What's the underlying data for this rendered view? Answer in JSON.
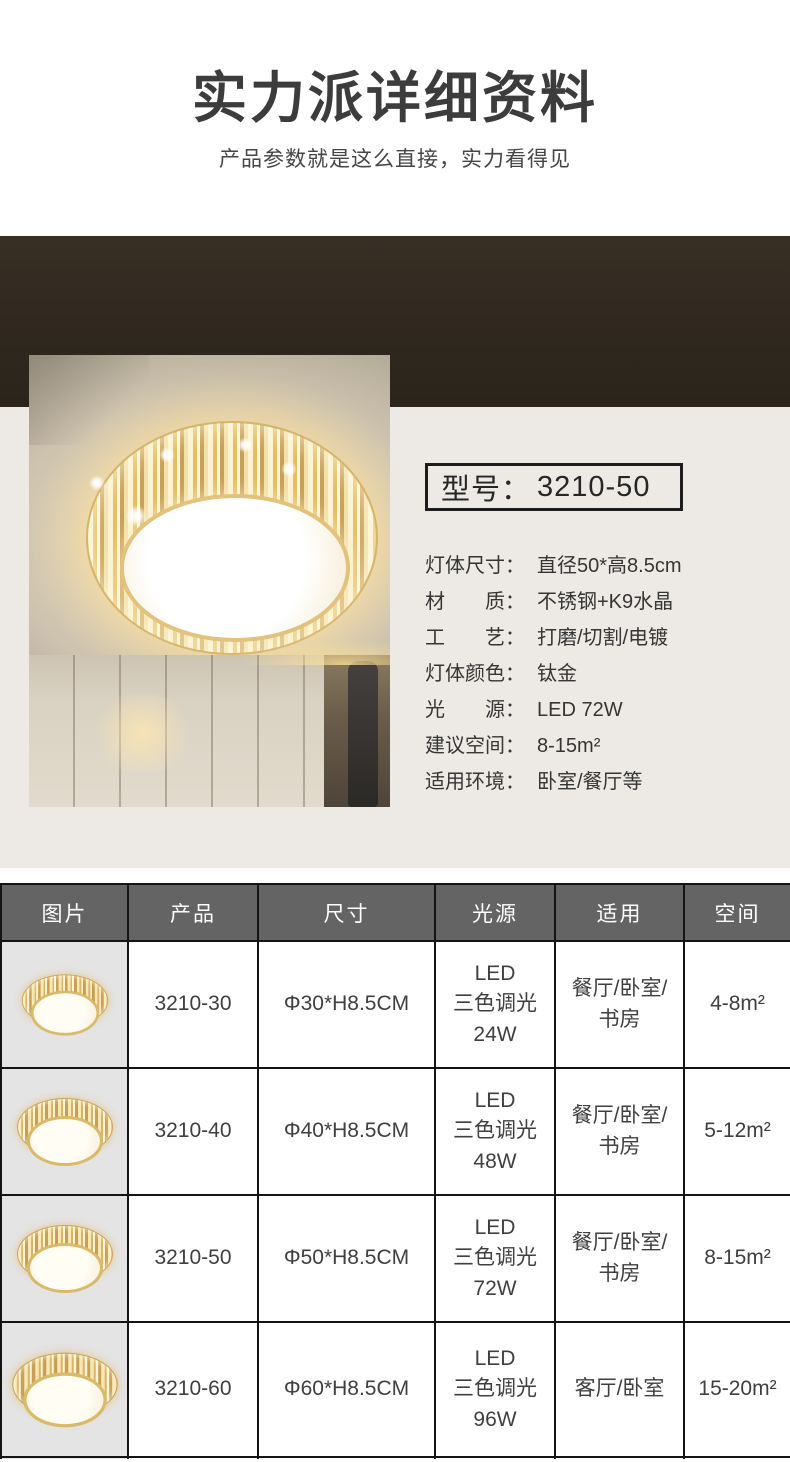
{
  "header": {
    "title": "实力派详细资料",
    "subtitle": "产品参数就是这么直接，实力看得见"
  },
  "hero": {
    "photo_description": "crystal round LED ceiling lamp on warm beige ceiling above wardrobe",
    "model_label": "型号：",
    "model_value": "3210-50",
    "specs": [
      {
        "label": "灯体尺寸",
        "value": "直径50*高8.5cm"
      },
      {
        "label": "材　　质",
        "value": "不锈钢+K9水晶"
      },
      {
        "label": "工　　艺",
        "value": "打磨/切割/电镀"
      },
      {
        "label": "灯体颜色",
        "value": "钛金"
      },
      {
        "label": "光　　源",
        "value": "LED 72W"
      },
      {
        "label": "建议空间",
        "value": "8-15m²"
      },
      {
        "label": "适用环境",
        "value": "卧室/餐厅等"
      }
    ],
    "colon": "："
  },
  "table": {
    "headers": [
      "图片",
      "产品",
      "尺寸",
      "光源",
      "适用",
      "空间"
    ],
    "rows": [
      {
        "image": "gold-crystal-ceiling-lamp",
        "product": "3210-30",
        "size": "Φ30*H8.5CM",
        "light": "LED\n三色调光\n24W",
        "usage": "餐厅/卧室/\n书房",
        "area": "4-8m²"
      },
      {
        "image": "gold-crystal-ceiling-lamp",
        "product": "3210-40",
        "size": "Φ40*H8.5CM",
        "light": "LED\n三色调光\n48W",
        "usage": "餐厅/卧室/\n书房",
        "area": "5-12m²"
      },
      {
        "image": "gold-crystal-ceiling-lamp",
        "product": "3210-50",
        "size": "Φ50*H8.5CM",
        "light": "LED\n三色调光\n72W",
        "usage": "餐厅/卧室/\n书房",
        "area": "8-15m²"
      },
      {
        "image": "gold-crystal-ceiling-lamp",
        "product": "3210-60",
        "size": "Φ60*H8.5CM",
        "light": "LED\n三色调光\n96W",
        "usage": "客厅/卧室",
        "area": "15-20m²"
      }
    ]
  },
  "colors": {
    "band_top": "#372e24",
    "band_bottom": "#2b241b",
    "cream_panel": "#edeae5",
    "table_header_bg": "#646464",
    "picture_cell_bg": "#e4e4e4",
    "border": "#141414",
    "text": "#3a3a3a",
    "lamp_gold": "#d9b96a"
  }
}
